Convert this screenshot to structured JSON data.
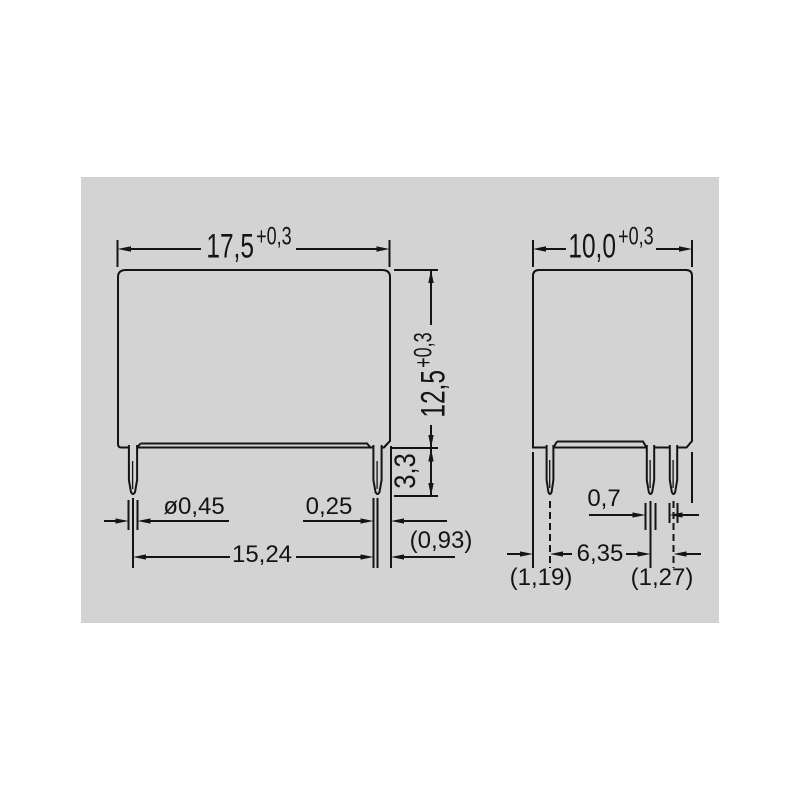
{
  "drawing": {
    "title": "relay-package-dimension-drawing",
    "units_style": "millimetres-comma-decimal",
    "colors": {
      "page_bg": "#ffffff",
      "panel_bg": "#d3d3d3",
      "line": "#141414"
    },
    "front_view": {
      "width_dim": {
        "value": "17,5",
        "tolerance": "+0,3"
      },
      "height_dim": {
        "value": "12,5",
        "tolerance": "+0,3"
      },
      "pin_protrusion_dim": {
        "value": "3,3"
      },
      "pin_diameter_dim": {
        "value": "ø0,45"
      },
      "pin_thickness_dim": {
        "value": "0,25"
      },
      "pin_pitch_dim": {
        "value": "15,24"
      },
      "edge_offset_dim": {
        "value": "(0,93)"
      }
    },
    "side_view": {
      "width_dim": {
        "value": "10,0",
        "tolerance": "+0,3"
      },
      "pin_width_dim": {
        "value": "0,7"
      },
      "pin_pitch_dim": {
        "value": "6,35"
      },
      "left_offset_dim": {
        "value": "(1,19)"
      },
      "right_offset_dim": {
        "value": "(1,27)"
      }
    }
  }
}
